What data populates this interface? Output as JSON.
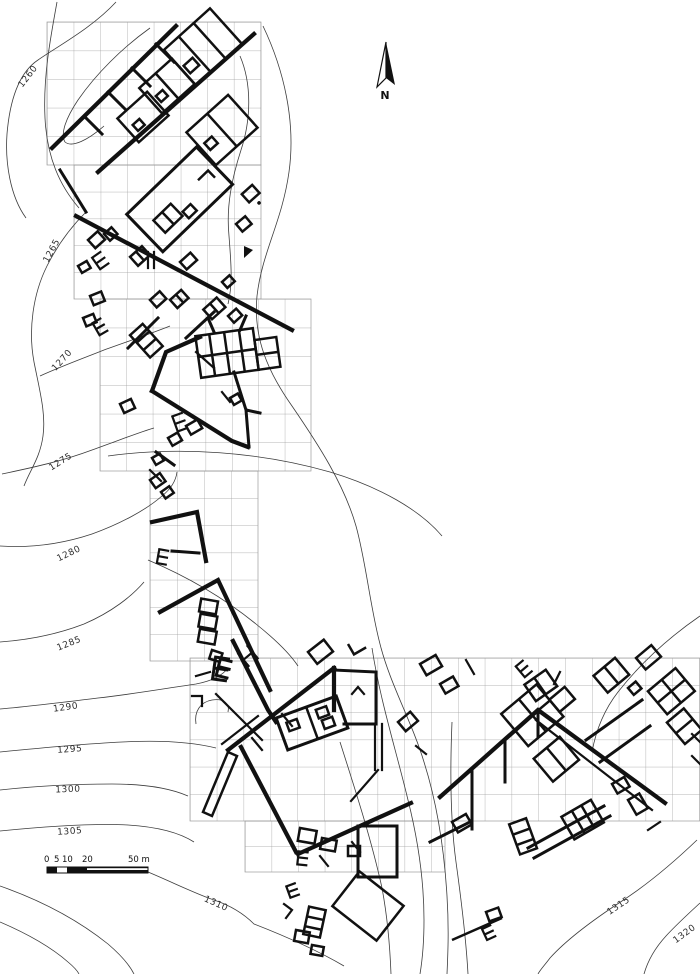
{
  "map": {
    "north_label": "N",
    "scale_bar": {
      "labels": [
        "0",
        "5",
        "10",
        "20",
        "50 m"
      ]
    },
    "contour_labels": [
      {
        "text": "1260"
      },
      {
        "text": "1265"
      },
      {
        "text": "1270"
      },
      {
        "text": "1275"
      },
      {
        "text": "1280"
      },
      {
        "text": "1285"
      },
      {
        "text": "1290"
      },
      {
        "text": "1295"
      },
      {
        "text": "1300"
      },
      {
        "text": "1305"
      },
      {
        "text": "1310"
      },
      {
        "text": "1315"
      },
      {
        "text": "1320"
      }
    ],
    "colors": {
      "ink": "#111111",
      "contour": "#3c3c3c",
      "grid": "#9b9b9b",
      "background": "#ffffff"
    }
  }
}
